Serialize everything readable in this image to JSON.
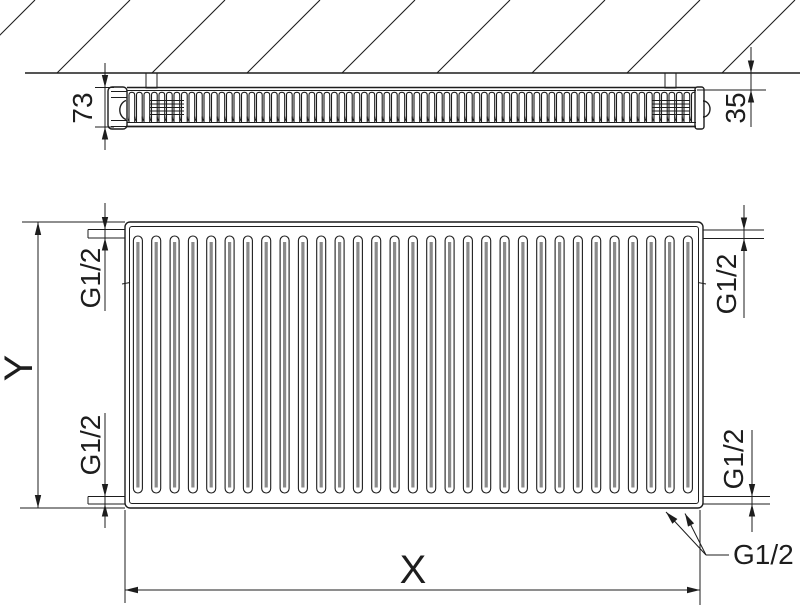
{
  "labels": {
    "depth": "73",
    "wall_distance": "35",
    "height": "Y",
    "width": "X",
    "connection": "G1/2"
  },
  "top_view": {
    "hatch_line_count": 9
  },
  "front_view": {
    "corrugation_count": 31
  },
  "colors": {
    "line": "#1d1d1d",
    "corrugation_gray": "#8a8a8a",
    "background": "#ffffff"
  }
}
